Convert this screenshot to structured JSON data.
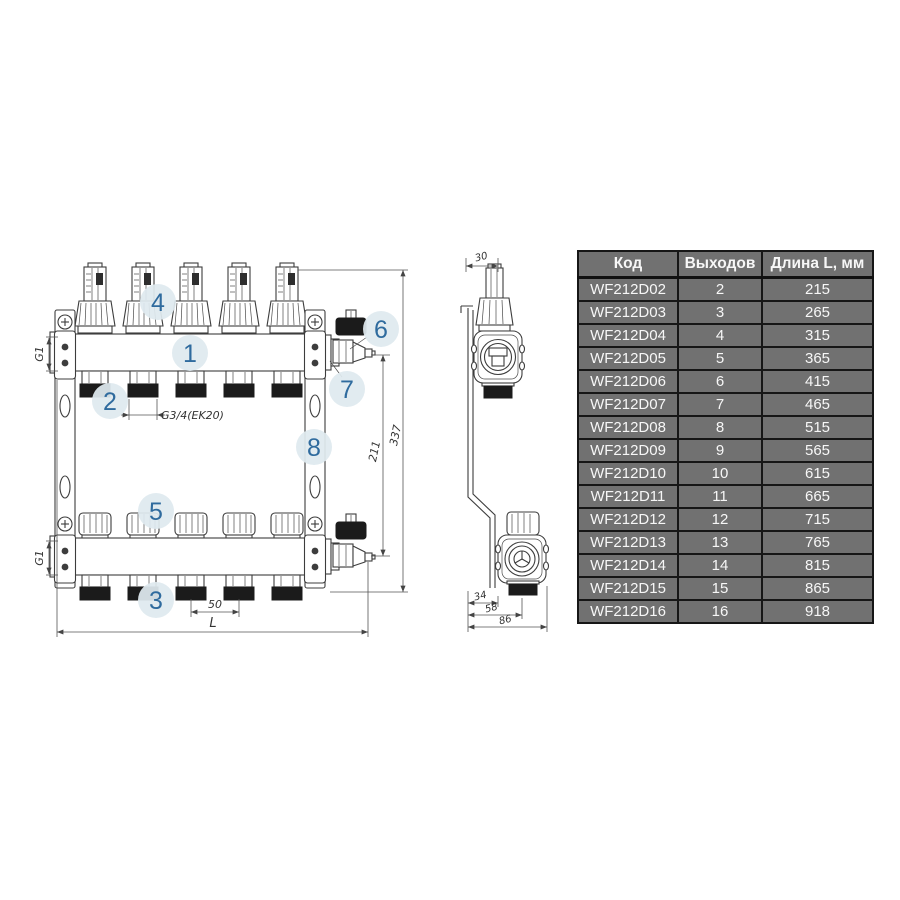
{
  "colors": {
    "line": "#3d3d3d",
    "dark_fill": "#1b1b1b",
    "callout_bg": "#dfe9ef",
    "callout_text": "#2f6b9e",
    "table_bg": "#717171",
    "table_border": "#161616",
    "table_text": "#f7f7f7"
  },
  "diagram": {
    "callouts": {
      "c1": "1",
      "c2": "2",
      "c3": "3",
      "c4": "4",
      "c5": "5",
      "c6": "6",
      "c7": "7",
      "c8": "8"
    },
    "dimensions": {
      "g1_top": "G1",
      "g1_bottom": "G1",
      "g34": "G3/4(EK20)",
      "d50": "50",
      "L": "L",
      "d211": "211",
      "d337": "337",
      "d30": "30",
      "d34": "34",
      "d58": "58",
      "d86": "86"
    }
  },
  "table": {
    "headers": [
      "Код",
      "Выходов",
      "Длина L, мм"
    ],
    "rows": [
      {
        "code": "WF212D02",
        "outputs": "2",
        "length": "215"
      },
      {
        "code": "WF212D03",
        "outputs": "3",
        "length": "265"
      },
      {
        "code": "WF212D04",
        "outputs": "4",
        "length": "315"
      },
      {
        "code": "WF212D05",
        "outputs": "5",
        "length": "365"
      },
      {
        "code": "WF212D06",
        "outputs": "6",
        "length": "415"
      },
      {
        "code": "WF212D07",
        "outputs": "7",
        "length": "465"
      },
      {
        "code": "WF212D08",
        "outputs": "8",
        "length": "515"
      },
      {
        "code": "WF212D09",
        "outputs": "9",
        "length": "565"
      },
      {
        "code": "WF212D10",
        "outputs": "10",
        "length": "615"
      },
      {
        "code": "WF212D11",
        "outputs": "11",
        "length": "665"
      },
      {
        "code": "WF212D12",
        "outputs": "12",
        "length": "715"
      },
      {
        "code": "WF212D13",
        "outputs": "13",
        "length": "765"
      },
      {
        "code": "WF212D14",
        "outputs": "14",
        "length": "815"
      },
      {
        "code": "WF212D15",
        "outputs": "15",
        "length": "865"
      },
      {
        "code": "WF212D16",
        "outputs": "16",
        "length": "918"
      }
    ]
  }
}
